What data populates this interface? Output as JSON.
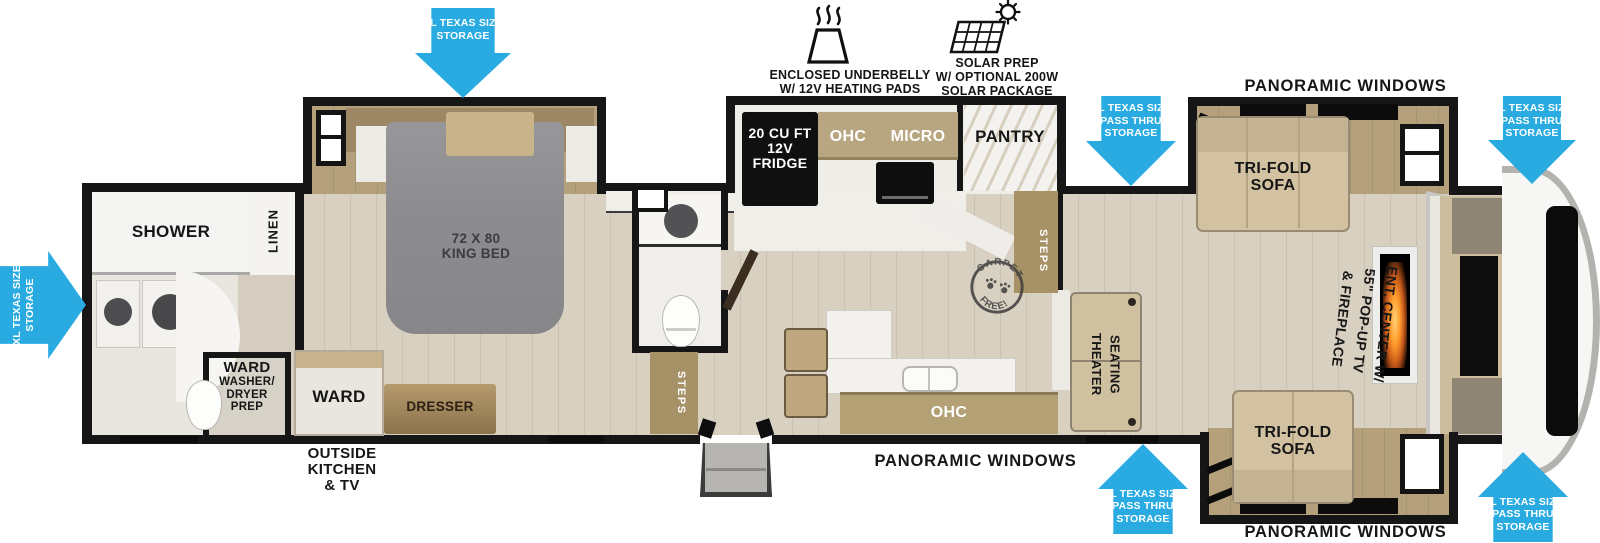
{
  "legend": {
    "underbelly": {
      "lines": [
        "ENCLOSED UNDERBELLY",
        "W/ 12V HEATING PADS"
      ]
    },
    "solar": {
      "lines": [
        "SOLAR PREP",
        "W/ OPTIONAL 200W",
        "SOLAR PACKAGE"
      ]
    }
  },
  "arrows": {
    "rear_storage": {
      "lines": [
        "XL TEXAS SIZE",
        "STORAGE"
      ]
    },
    "bedroom_storage": {
      "lines": [
        "XL TEXAS SIZE",
        "STORAGE"
      ]
    },
    "kitchen_pass_thru": {
      "lines": [
        "XL TEXAS SIZE",
        "PASS THRU",
        "STORAGE"
      ]
    },
    "front_top_pass_thru": {
      "lines": [
        "XL TEXAS SIZE",
        "PASS THRU",
        "STORAGE"
      ]
    },
    "living_pass_thru": {
      "lines": [
        "XL TEXAS SIZE",
        "PASS THRU",
        "STORAGE"
      ]
    },
    "front_bottom_pass_thru": {
      "lines": [
        "XL TEXAS SIZE",
        "PASS THRU",
        "STORAGE"
      ]
    }
  },
  "window_labels": {
    "top_right": "PANORAMIC WINDOWS",
    "bottom_center": "PANORAMIC WINDOWS",
    "bottom_right": "PANORAMIC WINDOWS"
  },
  "labels": {
    "shower": "SHOWER",
    "linen": "LINEN",
    "ward_washer": {
      "lines": [
        "WARD",
        "WASHER/",
        "DRYER",
        "PREP"
      ]
    },
    "ward": "WARD",
    "dresser": "DRESSER",
    "king_bed": {
      "lines": [
        "72 X 80",
        "KING BED"
      ]
    },
    "outside_kitchen": {
      "lines": [
        "OUTSIDE",
        "KITCHEN",
        "& TV"
      ]
    },
    "steps_bedroom": "STEPS",
    "steps_living": "STEPS",
    "fridge": {
      "lines": [
        "20 CU FT",
        "12V",
        "FRIDGE"
      ]
    },
    "ohc": "OHC",
    "micro": "MICRO",
    "pantry": "PANTRY",
    "ohc_island": "OHC",
    "theater_seating": {
      "lines": [
        "THEATER",
        "SEATING"
      ]
    },
    "tri_fold_sofa_top": {
      "lines": [
        "TRI-FOLD",
        "SOFA"
      ]
    },
    "tri_fold_sofa_bottom": {
      "lines": [
        "TRI-FOLD",
        "SOFA"
      ]
    },
    "ent_center": {
      "lines": [
        "ENT. CENTER W/",
        "55\" POP-UP TV",
        "& FIREPLACE"
      ]
    },
    "carpet_free": {
      "arc_top": "CARPET",
      "arc_bottom": "FREE!"
    }
  },
  "colors": {
    "arrow_blue": "#29abe2",
    "wall": "#161616",
    "floor": "#d8d1c2",
    "wood": "#b4a17c",
    "sofa": "#d2c2a2",
    "counter": "#f2f1ed",
    "bed_gray": "#8d8d8f"
  }
}
